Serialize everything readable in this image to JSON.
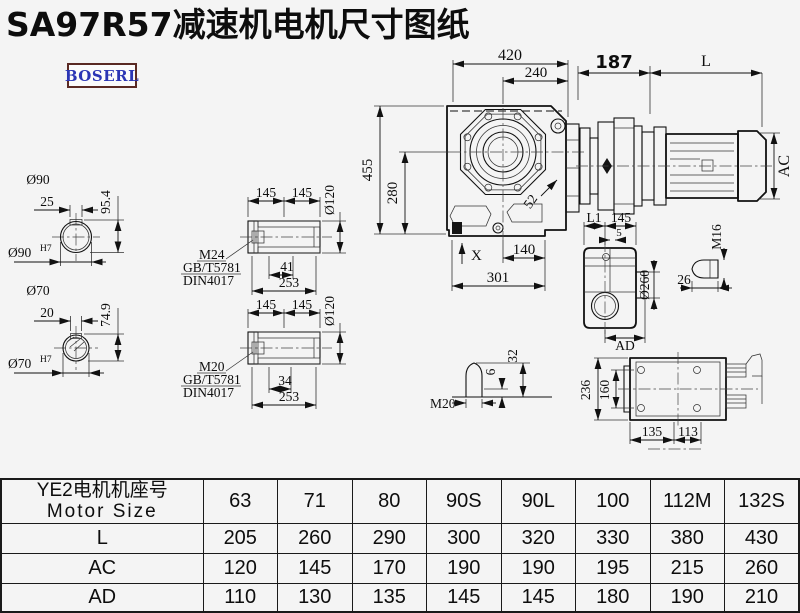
{
  "title": "SA97R57减速机电机尺寸图纸",
  "brand": "BOSERL",
  "views": {
    "front": {
      "w420": "420",
      "w240": "240",
      "h455": "455",
      "h280": "280",
      "a52": "52",
      "w140": "140",
      "w301": "301",
      "x_mark": "X"
    },
    "motor": {
      "w187": "187",
      "len": "L",
      "ac": "AC"
    },
    "circle90": {
      "dia": "Ø90",
      "key": "25",
      "height": "95.4",
      "fit": "Ø90",
      "fit_sup": "H7"
    },
    "circle70": {
      "dia": "Ø70",
      "key": "20",
      "height": "74.9",
      "fit": "Ø70",
      "fit_sup": "H7"
    },
    "shaft_m24": {
      "l1": "145",
      "l2": "145",
      "dia": "Ø120",
      "thread": "M24",
      "std1": "GB/T5781",
      "std2": "DIN4017",
      "tlen": "41",
      "total": "253"
    },
    "shaft_m20": {
      "l1": "145",
      "l2": "145",
      "dia": "Ø120",
      "thread": "M20",
      "std1": "GB/T5781",
      "std2": "DIN4017",
      "tlen": "34",
      "total": "253"
    },
    "side": {
      "l1": "L1",
      "l145": "145",
      "wall": "5",
      "dia": "Ø260",
      "ad": "AD",
      "plug": "M16",
      "plug_len": "26"
    },
    "breather": {
      "thread": "M20",
      "tip": "6",
      "total": "32"
    },
    "top": {
      "h236": "236",
      "h160": "160",
      "w135": "135",
      "w113": "113"
    }
  },
  "table": {
    "header_cn": "YE2电机机座号",
    "header_en": "Motor Size",
    "sizes": [
      "63",
      "71",
      "80",
      "90S",
      "90L",
      "100",
      "112M",
      "132S"
    ],
    "rows": [
      {
        "label": "L",
        "values": [
          "205",
          "260",
          "290",
          "300",
          "320",
          "330",
          "380",
          "430"
        ]
      },
      {
        "label": "AC",
        "values": [
          "120",
          "145",
          "170",
          "190",
          "190",
          "195",
          "215",
          "260"
        ]
      },
      {
        "label": "AD",
        "values": [
          "110",
          "130",
          "135",
          "145",
          "145",
          "180",
          "190",
          "210"
        ]
      }
    ]
  }
}
